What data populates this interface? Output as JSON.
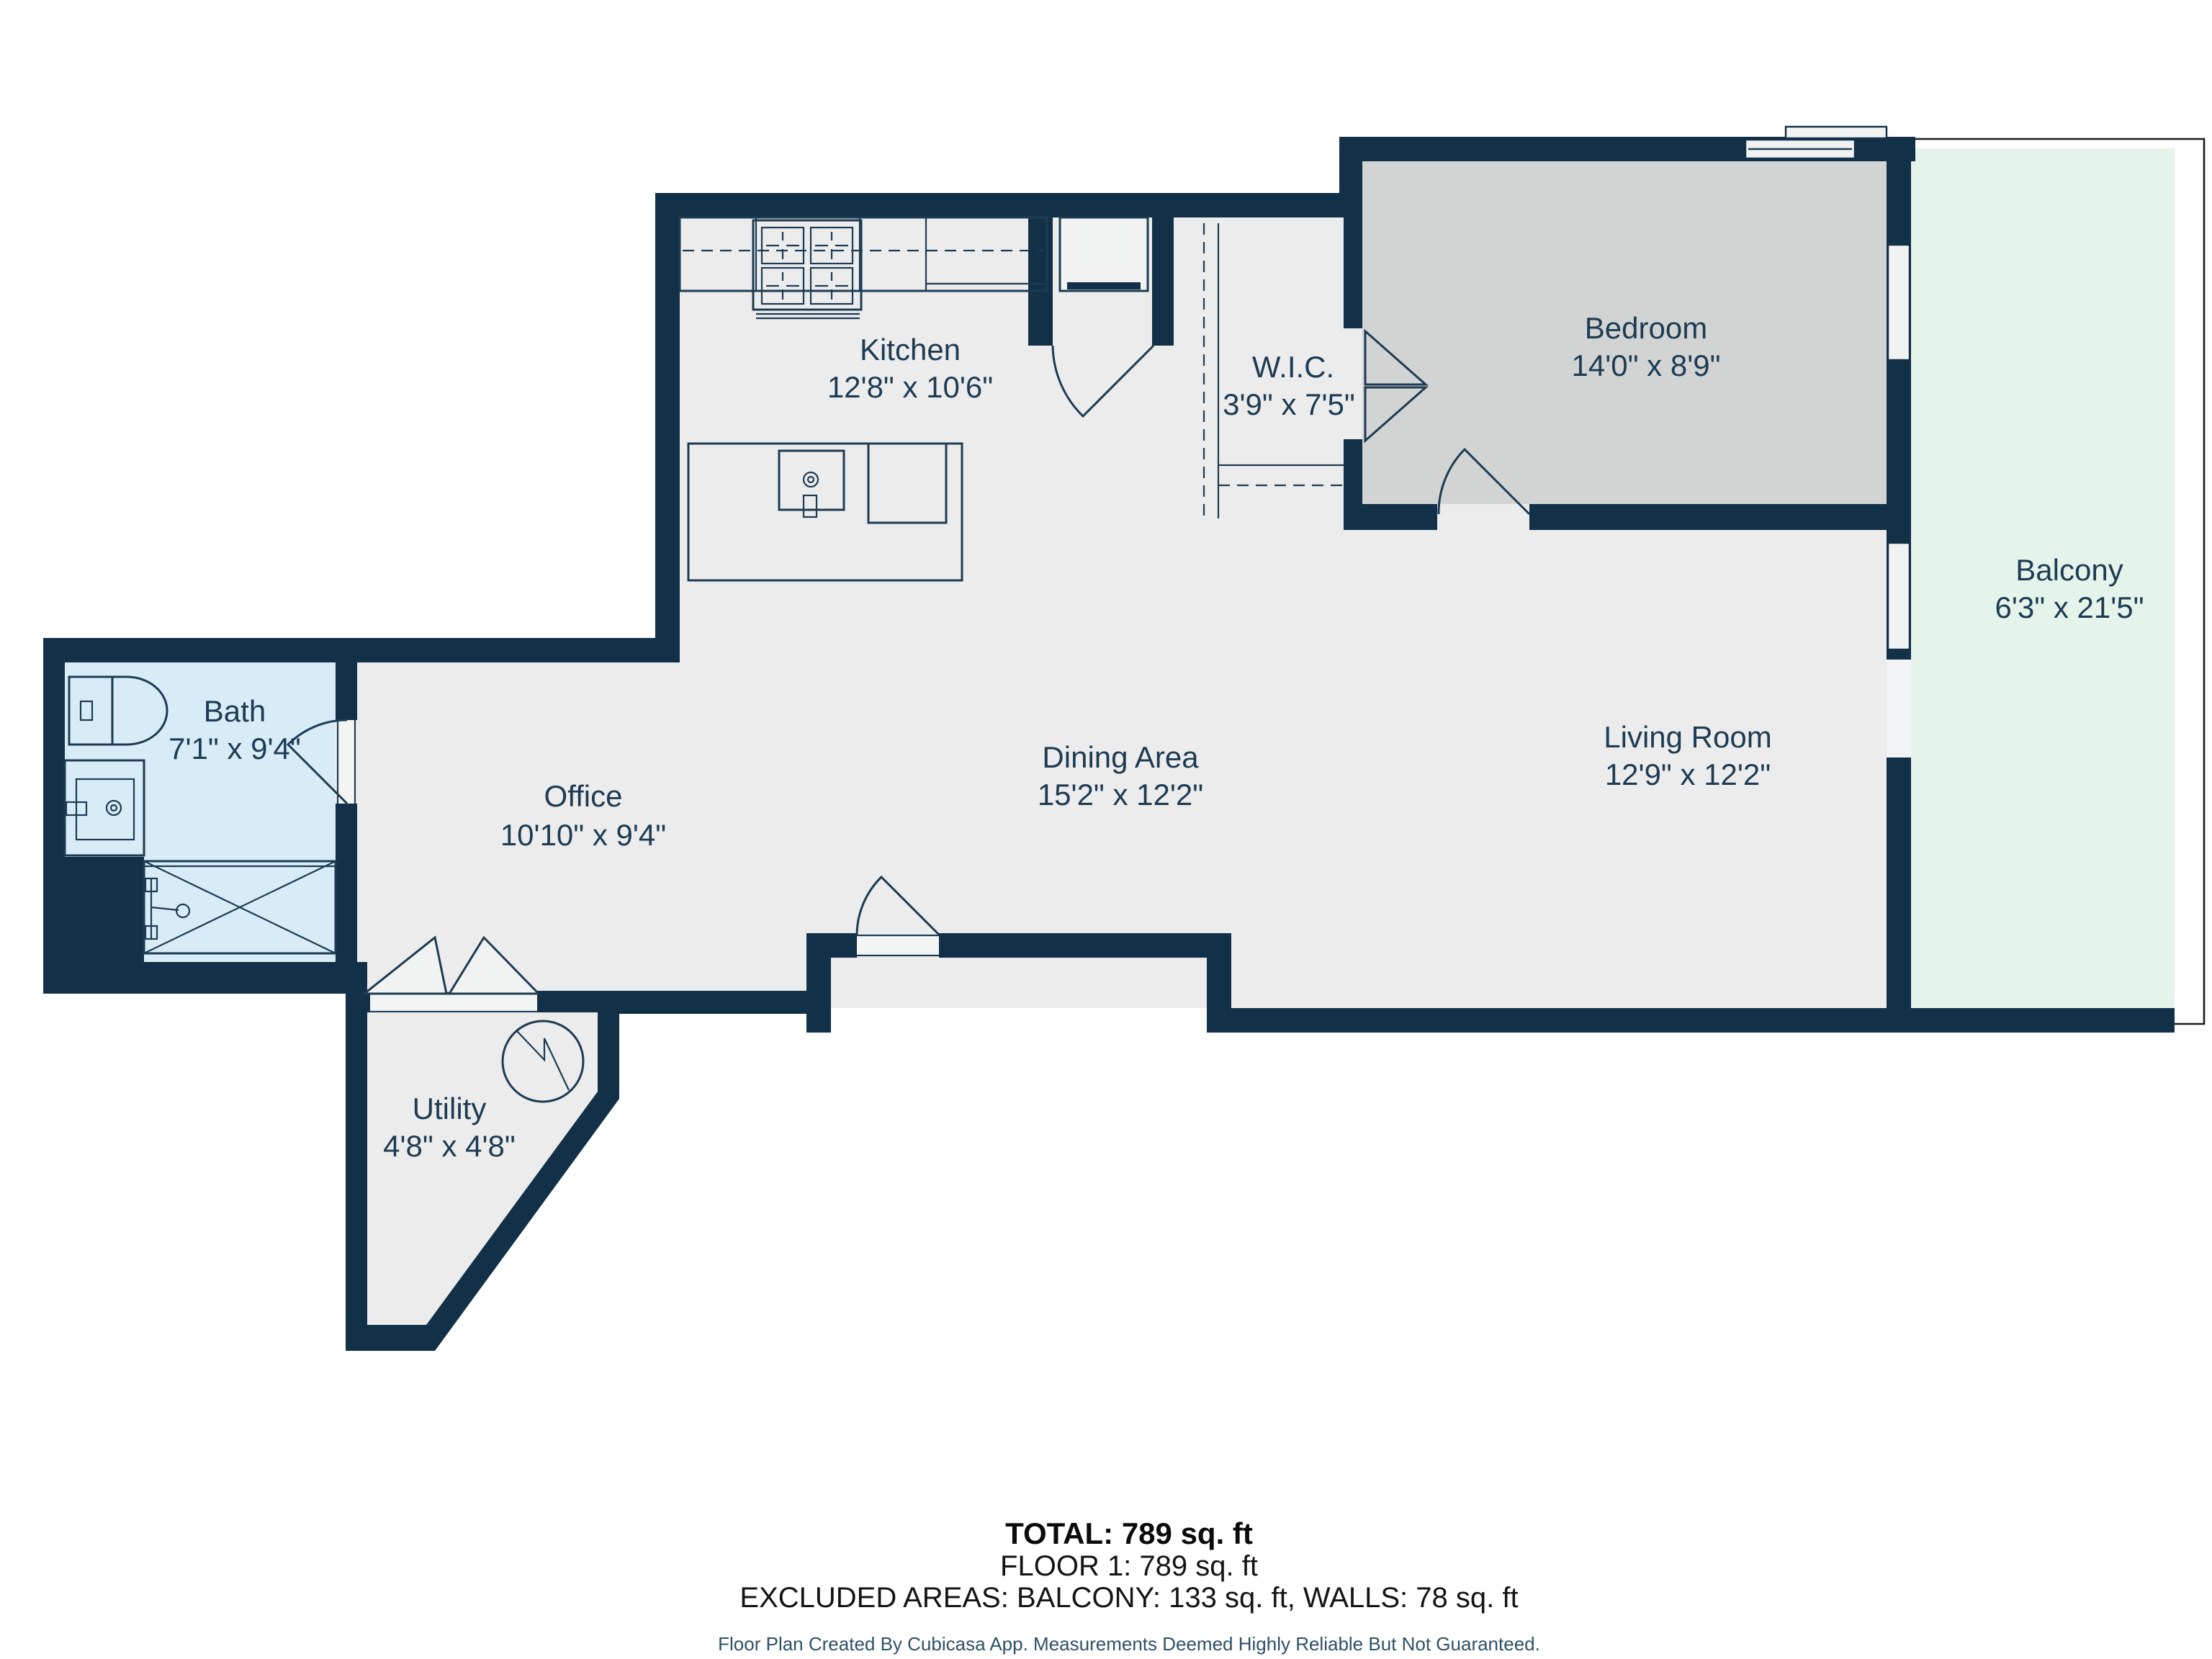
{
  "colors": {
    "wall": "#123047",
    "floor": "#ececed",
    "bed": "#d2d4d4",
    "bath": "#d8ecf8",
    "balcony": "#e4f4ea",
    "line": "#1d3b52",
    "label": "#1d3b52"
  },
  "rooms": {
    "kitchen": {
      "name": "Kitchen",
      "dims": "12'8\" x 10'6\""
    },
    "wic": {
      "name": "W.I.C.",
      "dims": "3'9\" x 7'5\""
    },
    "bedroom": {
      "name": "Bedroom",
      "dims": "14'0\" x 8'9\""
    },
    "balcony": {
      "name": "Balcony",
      "dims": "6'3\" x 21'5\""
    },
    "bath": {
      "name": "Bath",
      "dims": "7'1\" x 9'4\""
    },
    "office": {
      "name": "Office",
      "dims": "10'10\" x 9'4\""
    },
    "dining": {
      "name": "Dining Area",
      "dims": "15'2\" x 12'2\""
    },
    "living": {
      "name": "Living Room",
      "dims": "12'9\" x 12'2\""
    },
    "utility": {
      "name": "Utility",
      "dims": "4'8\" x 4'8\""
    }
  },
  "summary": {
    "total": "TOTAL: 789 sq. ft",
    "floor": "FLOOR 1: 789 sq. ft",
    "excluded": "EXCLUDED AREAS: BALCONY: 133 sq. ft, WALLS: 78 sq. ft",
    "disclaimer": "Floor Plan Created By Cubicasa App. Measurements Deemed Highly Reliable But Not Guaranteed."
  }
}
